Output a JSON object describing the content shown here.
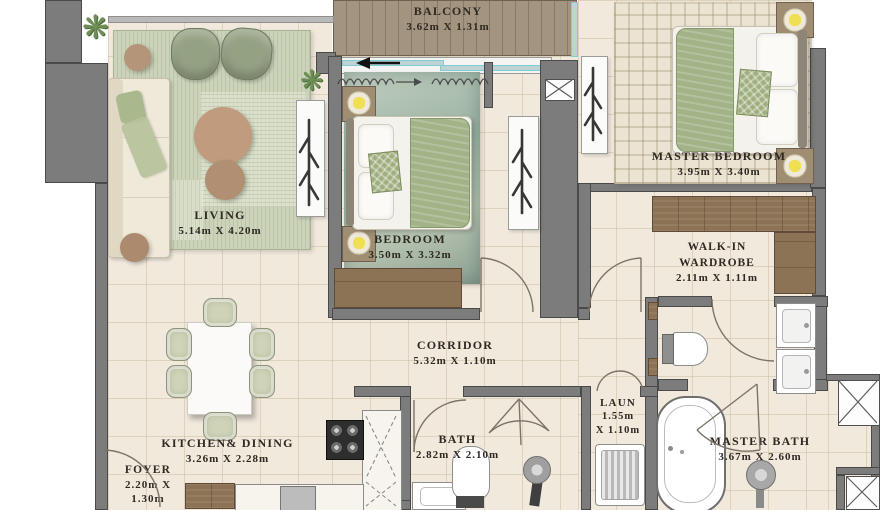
{
  "plan": {
    "rooms": {
      "balcony": {
        "name": "BALCONY",
        "dims": "3.62m X 1.31m"
      },
      "living": {
        "name": "LIVING",
        "dims": "5.14m X 4.20m"
      },
      "bedroom": {
        "name": "BEDROOM",
        "dims": "3.50m X 3.32m"
      },
      "master_bedroom": {
        "name": "MASTER BEDROOM",
        "dims": "3.95m X 3.40m"
      },
      "walk_in_wardrobe": {
        "name_line1": "WALK-IN",
        "name_line2": "WARDROBE",
        "dims": "2.11m X 1.11m"
      },
      "corridor": {
        "name": "CORRIDOR",
        "dims": "5.32m X 1.10m"
      },
      "kitchen_dining": {
        "name": "KITCHEN& DINING",
        "dims": "3.26m X 2.28m"
      },
      "foyer": {
        "name": "FOYER",
        "dims_line1": "2.20m X",
        "dims_line2": "1.30m"
      },
      "bath": {
        "name": "BATH",
        "dims": "2.82m X 2.10m"
      },
      "laundry": {
        "name": "LAUN",
        "dims_line1": "1.55m",
        "dims_line2": "X 1.10m"
      },
      "master_bath": {
        "name": "MASTER BATH",
        "dims": "3.67m X 2.60m"
      }
    },
    "icons": {
      "plant": "❋"
    },
    "colors": {
      "wall": "#7c7c7c",
      "floor": "#f1e9dc",
      "wood": "#8d7356",
      "rug_green": "#cbd3b9",
      "glass_teal": "#7ecfd3",
      "lamp_yellow": "#f0df55",
      "deck": "#a2947f",
      "text": "#2e2922"
    }
  }
}
